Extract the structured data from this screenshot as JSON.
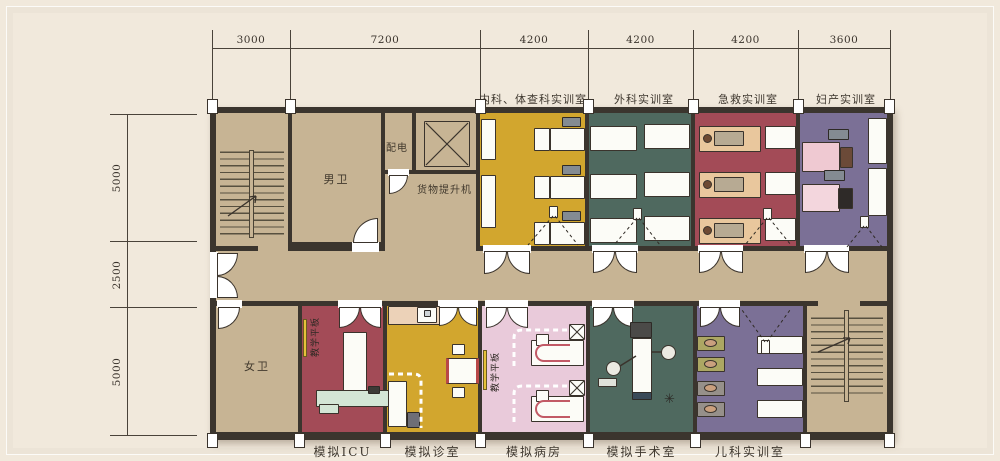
{
  "plan": {
    "dim_top": [
      "3000",
      "7200",
      "4200",
      "4200",
      "4200",
      "3600"
    ],
    "dim_left": [
      "5000",
      "2500",
      "5000"
    ],
    "top_rooms": {
      "internal_exam": "内科、体查科实训室",
      "surgery": "外科实训室",
      "emergency": "急救实训室",
      "obstetrics": "妇产实训室"
    },
    "bottom_rooms": {
      "icu": "模拟ICU",
      "clinic": "模拟诊室",
      "ward": "模拟病房",
      "operating": "模拟手术室",
      "pediatrics": "儿科实训室"
    },
    "inner_labels": {
      "male_toilet": "男卫",
      "female_toilet": "女卫",
      "power_room": "配电",
      "cargo_lift": "货物提升机",
      "teaching_panel_icu": "教学平板",
      "teaching_panel_ward": "教学平板"
    },
    "icons": {
      "instrument_star": "✳"
    },
    "colors": {
      "background": "#f1e9dc",
      "wall": "#3b352e",
      "corridor_tan": "#c7b494",
      "room_yellow": "#d2a62e",
      "room_teal": "#4f695f",
      "room_red": "#a34b57",
      "room_purple": "#7b7096",
      "room_pink": "#e9cada",
      "teaching_strip_yellow": "#e6c23a",
      "counter_beige": "#ecd2b8",
      "icu_platform_mint": "#d4e6d6"
    }
  }
}
